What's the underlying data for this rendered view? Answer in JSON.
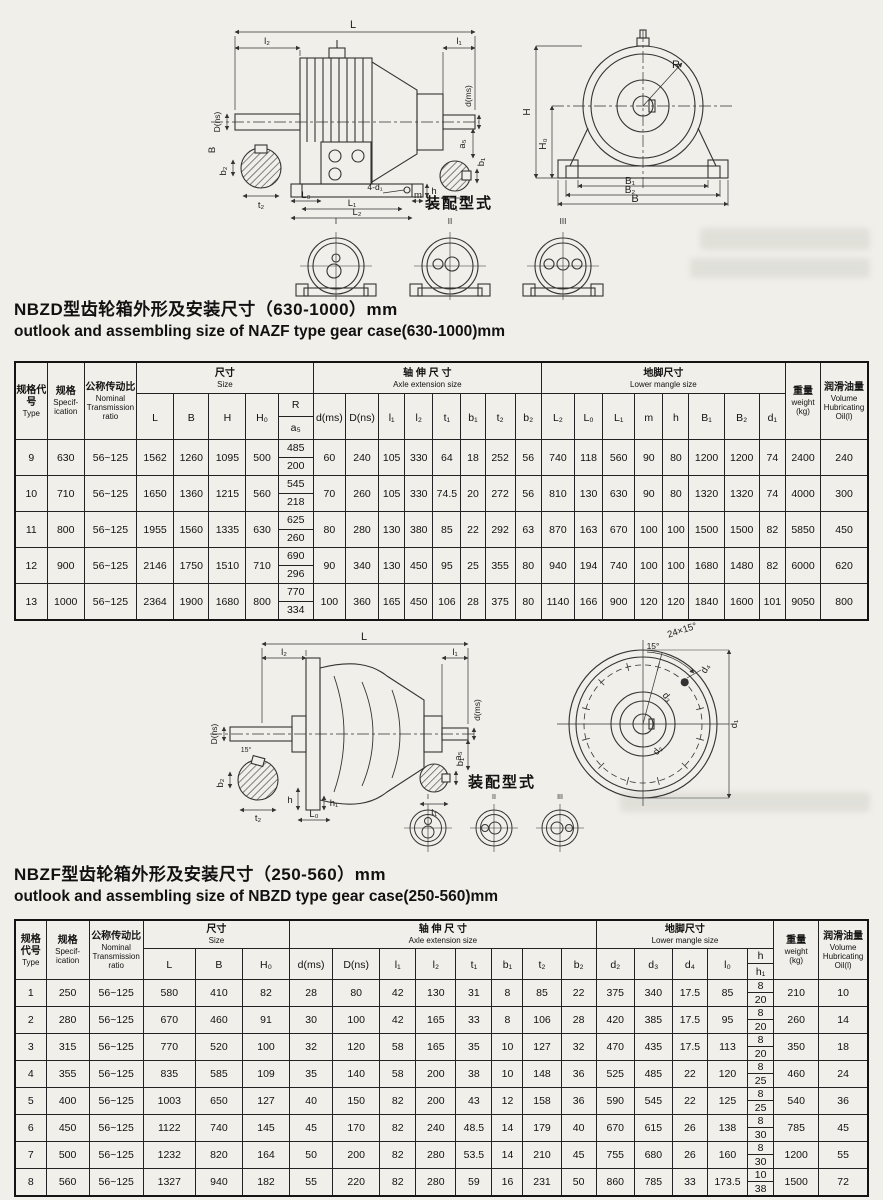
{
  "s1": {
    "title_zh": "NBZD型齿轮箱外形及安装尺寸（630-1000）mm",
    "title_en": "outlook and assembling size of NAZF type gear case(630-1000)mm",
    "assembly_title": "装配型式",
    "assembly_types": [
      "I",
      "II",
      "III"
    ],
    "side_labels": {
      "L": "L",
      "l2": "l₂",
      "l1": "l₁",
      "dms": "d(ms)",
      "Dns": "D(ns)",
      "B": "B",
      "a5": "a₅",
      "b1": "b₁",
      "t1": "t₁",
      "b2": "b₂",
      "t2": "t₂",
      "L0": "L₀",
      "L1": "L₁",
      "L2": "L₂",
      "m": "m",
      "h": "h",
      "d1": "4-d₁"
    },
    "front_labels": {
      "H": "H",
      "H0": "H₀",
      "R": "R",
      "B1": "B₁",
      "B2": "B₂",
      "B": "B"
    },
    "table": {
      "h_type_zh": "规格代号",
      "h_type_en": "Type",
      "h_spec_zh": "规格",
      "h_spec_en": "Specif-ication",
      "h_ratio_zh": "公称传动比",
      "h_ratio_en": "Nominal Transmission ratio",
      "h_size_zh": "尺寸",
      "h_size_en": "Size",
      "h_axle_zh": "轴 伸 尺 寸",
      "h_axle_en": "Axle extension size",
      "h_foot_zh": "地脚尺寸",
      "h_foot_en": "Lower mangle size",
      "h_weight_zh": "重量",
      "h_weight_en": "weight",
      "h_weight_unit": "(kg)",
      "h_oil_zh": "润滑油量",
      "h_oil_en": "Volume Hubricating Oil(l)",
      "size_cols": [
        "L",
        "B",
        "H",
        "H₀"
      ],
      "r_top": "R",
      "r_bottom": "a₅",
      "axle_cols": [
        "d(ms)",
        "D(ns)",
        "l₁",
        "l₂",
        "t₁",
        "b₁",
        "t₂",
        "b₂"
      ],
      "foot_cols": [
        "L₂",
        "L₀",
        "L₁",
        "m",
        "h",
        "B₁",
        "B₂",
        "d₁"
      ],
      "rows": [
        [
          "9",
          "630",
          "56~125",
          "1562",
          "1260",
          "1095",
          "500",
          [
            "485",
            "200"
          ],
          "60",
          "240",
          "105",
          "330",
          "64",
          "18",
          "252",
          "56",
          "740",
          "118",
          "560",
          "90",
          "80",
          "1200",
          "1200",
          "74",
          "2400",
          "240"
        ],
        [
          "10",
          "710",
          "56~125",
          "1650",
          "1360",
          "1215",
          "560",
          [
            "545",
            "218"
          ],
          "70",
          "260",
          "105",
          "330",
          "74.5",
          "20",
          "272",
          "56",
          "810",
          "130",
          "630",
          "90",
          "80",
          "1320",
          "1320",
          "74",
          "4000",
          "300"
        ],
        [
          "11",
          "800",
          "56~125",
          "1955",
          "1560",
          "1335",
          "630",
          [
            "625",
            "260"
          ],
          "80",
          "280",
          "130",
          "380",
          "85",
          "22",
          "292",
          "63",
          "870",
          "163",
          "670",
          "100",
          "100",
          "1500",
          "1500",
          "82",
          "5850",
          "450"
        ],
        [
          "12",
          "900",
          "56~125",
          "2146",
          "1750",
          "1510",
          "710",
          [
            "690",
            "296"
          ],
          "90",
          "340",
          "130",
          "450",
          "95",
          "25",
          "355",
          "80",
          "940",
          "194",
          "740",
          "100",
          "100",
          "1680",
          "1480",
          "82",
          "6000",
          "620"
        ],
        [
          "13",
          "1000",
          "56~125",
          "2364",
          "1900",
          "1680",
          "800",
          [
            "770",
            "334"
          ],
          "100",
          "360",
          "165",
          "450",
          "106",
          "28",
          "375",
          "80",
          "1140",
          "166",
          "900",
          "120",
          "120",
          "1840",
          "1600",
          "101",
          "9050",
          "800"
        ]
      ]
    }
  },
  "s2": {
    "title_zh": "NBZF型齿轮箱外形及安装尺寸（250-560）mm",
    "title_en": "outlook and assembling size of NBZD type gear case(250-560)mm",
    "assembly_title": "装配型式",
    "assembly_types": [
      "I",
      "II",
      "III"
    ],
    "side_labels": {
      "L": "L",
      "l2": "l₂",
      "l1": "l₁",
      "dms": "d(ms)",
      "Dns": "D(ns)",
      "a5": "a₅",
      "b1": "b₁",
      "t1": "t₁",
      "b2": "b₂",
      "t2": "t₂",
      "h": "h",
      "h1": "h₁",
      "L0": "L₀",
      "angle": "15°"
    },
    "front_labels": {
      "bolt": "24×15°",
      "angle": "15°",
      "d1": "d₁",
      "d2": "d₂",
      "d3": "d₃",
      "d4": "d₄"
    },
    "table": {
      "h_type_zh": "规格代号",
      "h_type_en": "Type",
      "h_spec_zh": "规格",
      "h_spec_en": "Specif-ication",
      "h_ratio_zh": "公称传动比",
      "h_ratio_en": "Nominal Transmission ratio",
      "h_size_zh": "尺寸",
      "h_size_en": "Size",
      "h_axle_zh": "轴 伸 尺 寸",
      "h_axle_en": "Axle extension size",
      "h_foot_zh": "地脚尺寸",
      "h_foot_en": "Lower mangle size",
      "h_weight_zh": "重量",
      "h_weight_en": "weight",
      "h_weight_unit": "(kg)",
      "h_oil_zh": "润滑油量",
      "h_oil_en": "Volume Hubricating Oil(l)",
      "size_cols": [
        "L",
        "B",
        "H₀"
      ],
      "axle_cols": [
        "d(ms)",
        "D(ns)",
        "l₁",
        "l₂",
        "t₁",
        "b₁",
        "t₂",
        "b₂"
      ],
      "foot_cols": [
        "d₂",
        "d₃",
        "d₄",
        "l₀"
      ],
      "h_top": "h",
      "h_bottom": "h₁",
      "rows": [
        [
          "1",
          "250",
          "56~125",
          "580",
          "410",
          "82",
          "28",
          "80",
          "42",
          "130",
          "31",
          "8",
          "85",
          "22",
          "375",
          "340",
          "17.5",
          "85",
          [
            "8",
            "20"
          ],
          "210",
          "10"
        ],
        [
          "2",
          "280",
          "56~125",
          "670",
          "460",
          "91",
          "30",
          "100",
          "42",
          "165",
          "33",
          "8",
          "106",
          "28",
          "420",
          "385",
          "17.5",
          "95",
          [
            "8",
            "20"
          ],
          "260",
          "14"
        ],
        [
          "3",
          "315",
          "56~125",
          "770",
          "520",
          "100",
          "32",
          "120",
          "58",
          "165",
          "35",
          "10",
          "127",
          "32",
          "470",
          "435",
          "17.5",
          "113",
          [
            "8",
            "20"
          ],
          "350",
          "18"
        ],
        [
          "4",
          "355",
          "56~125",
          "835",
          "585",
          "109",
          "35",
          "140",
          "58",
          "200",
          "38",
          "10",
          "148",
          "36",
          "525",
          "485",
          "22",
          "120",
          [
            "8",
            "25"
          ],
          "460",
          "24"
        ],
        [
          "5",
          "400",
          "56~125",
          "1003",
          "650",
          "127",
          "40",
          "150",
          "82",
          "200",
          "43",
          "12",
          "158",
          "36",
          "590",
          "545",
          "22",
          "125",
          [
            "8",
            "25"
          ],
          "540",
          "36"
        ],
        [
          "6",
          "450",
          "56~125",
          "1122",
          "740",
          "145",
          "45",
          "170",
          "82",
          "240",
          "48.5",
          "14",
          "179",
          "40",
          "670",
          "615",
          "26",
          "138",
          [
            "8",
            "30"
          ],
          "785",
          "45"
        ],
        [
          "7",
          "500",
          "56~125",
          "1232",
          "820",
          "164",
          "50",
          "200",
          "82",
          "280",
          "53.5",
          "14",
          "210",
          "45",
          "755",
          "680",
          "26",
          "160",
          [
            "8",
            "30"
          ],
          "1200",
          "55"
        ],
        [
          "8",
          "560",
          "56~125",
          "1327",
          "940",
          "182",
          "55",
          "220",
          "82",
          "280",
          "59",
          "16",
          "231",
          "50",
          "860",
          "785",
          "33",
          "173.5",
          [
            "10",
            "38"
          ],
          "1500",
          "72"
        ]
      ]
    }
  }
}
